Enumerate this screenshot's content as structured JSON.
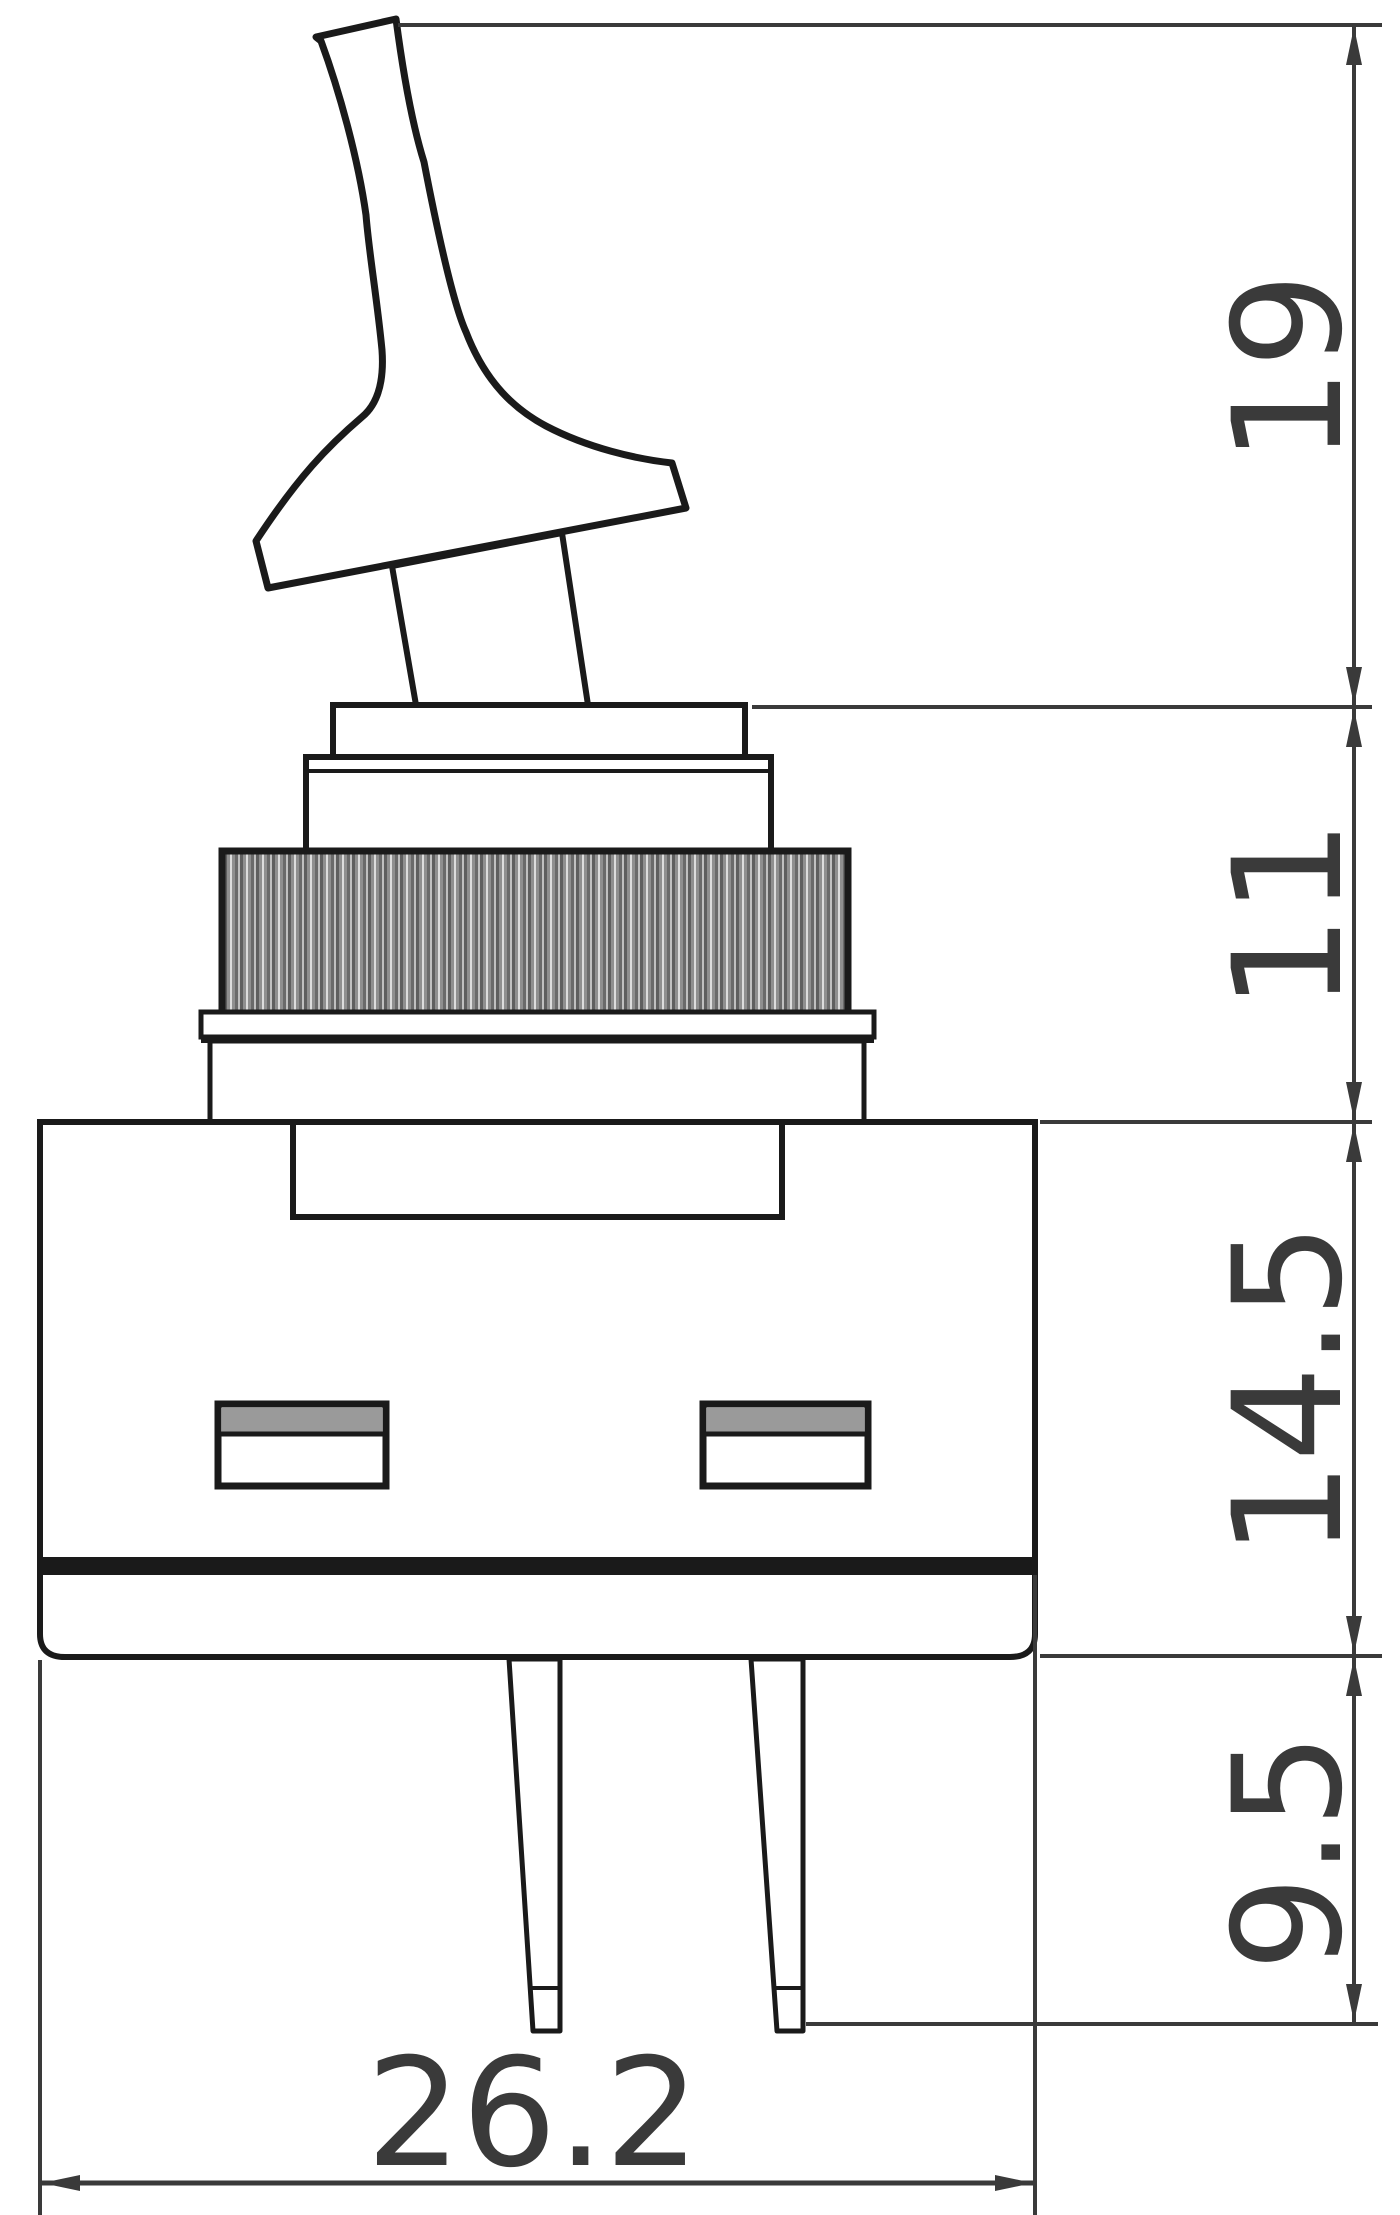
{
  "drawing": {
    "type": "technical-dimension-drawing",
    "subject": "toggle-switch-side-view",
    "dims": {
      "lever_height": "19",
      "bushing_height": "11",
      "body_height": "14.5",
      "pin_length": "9.5",
      "body_width": "26.2"
    },
    "colors": {
      "outline": "#1a1a1a",
      "dimension": "#3a3a3a",
      "text": "#3a3a3a",
      "knurl_dark": "#5f5f5f",
      "knurl_mid": "#8f8f8f",
      "knurl_light": "#dcdcdc",
      "slot_band": "#9a9a9a",
      "background": "#ffffff"
    }
  }
}
